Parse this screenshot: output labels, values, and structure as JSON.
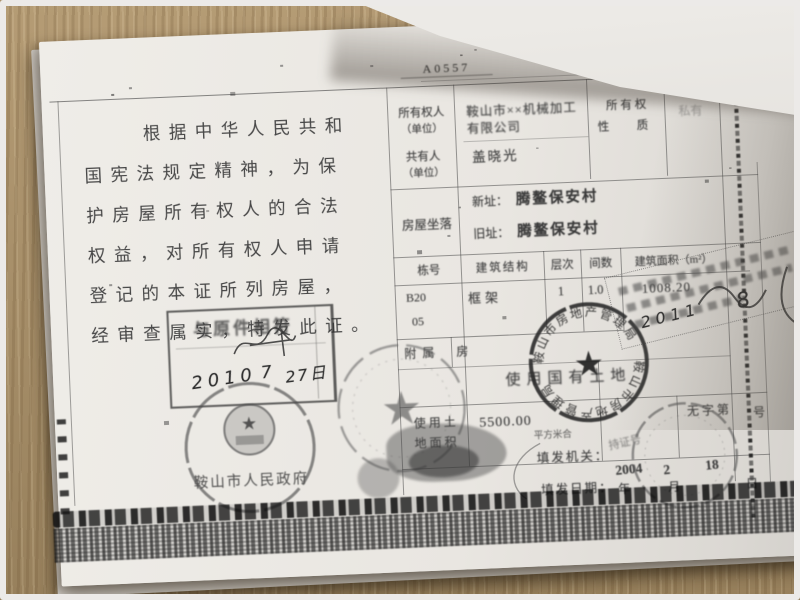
{
  "photo": {
    "surface": "wooden desk",
    "overlay": "curled page corner covering top-right",
    "wood_color": "#a8906a",
    "paper_color": "#e9e6e1",
    "ink_color": "#3f3f3f",
    "frame_color": "#eceae8"
  },
  "cert": {
    "serial": "A0557",
    "preamble": [
      "根据中华人民共和",
      "国宪法规定精神，为保",
      "护房屋所有权人的合法",
      "权益，对所有权人申请",
      "登记的本证所列房屋，",
      "经审查属实，特发此证。"
    ],
    "owner": {
      "l1": "所有权人",
      "l2": "（单位）",
      "v1": "鞍山市××机械加工",
      "v2": "有限公司"
    },
    "co": {
      "l1": "共有人",
      "l2": "（单位）",
      "v": "盖晓光"
    },
    "nature": {
      "l1": "所 有 权",
      "l2": "性　质",
      "v": "私有"
    },
    "loc": {
      "label": "房屋坐落",
      "new_l": "新址：",
      "new_v": "腾鳌保安村",
      "old_l": "旧址：",
      "old_v": "腾鳌保安村"
    },
    "bld": {
      "h1": "栋号",
      "h2": "建筑结构",
      "h3": "层次",
      "h4": "间数",
      "h5": "建筑面积（m²）",
      "dong1": "B20",
      "dong2": "05",
      "struct": "框架",
      "floor": "1",
      "rooms": "1.0",
      "area": "1008.20",
      "attached1": "附属",
      "attached2": "房"
    },
    "land": {
      "use": "使用国有土地",
      "al1": "使用土",
      "al2": "地面积",
      "av": "5500.00",
      "unit": "平方米合",
      "holder": "持证号",
      "nw": "无字第",
      "nws": "号"
    },
    "issue": {
      "org": "填发机关：",
      "date": "填发日期：",
      "y": "年",
      "m": "月",
      "d": "日"
    },
    "stamps": {
      "copy": "与原件相符",
      "hy": "2010",
      "hm": "7",
      "hd": "27日",
      "gov": "鞍山市人民政府",
      "ring": "鞍山市房地产管理局",
      "dy": "2004",
      "dm": "2",
      "dd": "18",
      "diag1": "2011",
      "diag2": "8"
    }
  }
}
